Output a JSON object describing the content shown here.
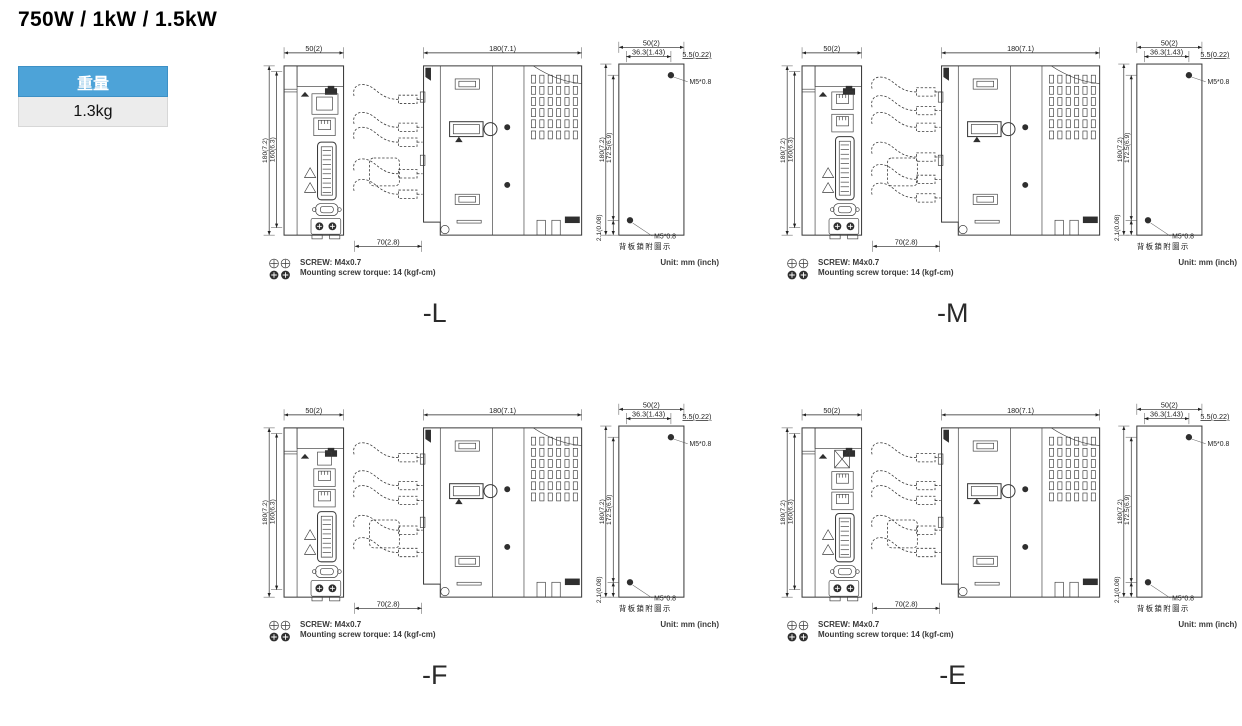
{
  "header": {
    "title": "750W / 1kW / 1.5kW"
  },
  "weight_table": {
    "header": "重量",
    "value": "1.3kg"
  },
  "colors": {
    "header_blue": "#4da3d8",
    "header_border": "#3d90c5",
    "cell_gray": "#ececec",
    "line_dark": "#3a3a3a"
  },
  "notes": {
    "screw": "SCREW: M4x0.7",
    "torque": "Mounting screw torque: 14 (kgf-cm)",
    "unit": "Unit: mm (inch)"
  },
  "dimensions": {
    "front_width": "50(2)",
    "front_height": "180(7.2)",
    "front_mount_height": "160(6.3)",
    "side_depth": "180(7.1)",
    "cable_clearance": "70(2.8)",
    "rear_width": "50(2)",
    "rear_hole_offset": "36.3(1.43)",
    "rear_edge_offset": "5.5(0.22)",
    "rear_height": "180(7.2)",
    "rear_hole_span": "172.5(6.9)",
    "rear_bottom_offset": "2.1(0.08)",
    "screw_thread": "M5*0.8",
    "rear_caption": "背板鎖附圖示"
  },
  "variants": [
    {
      "label": "-L"
    },
    {
      "label": "-M"
    },
    {
      "label": "-F"
    },
    {
      "label": "-E"
    }
  ]
}
